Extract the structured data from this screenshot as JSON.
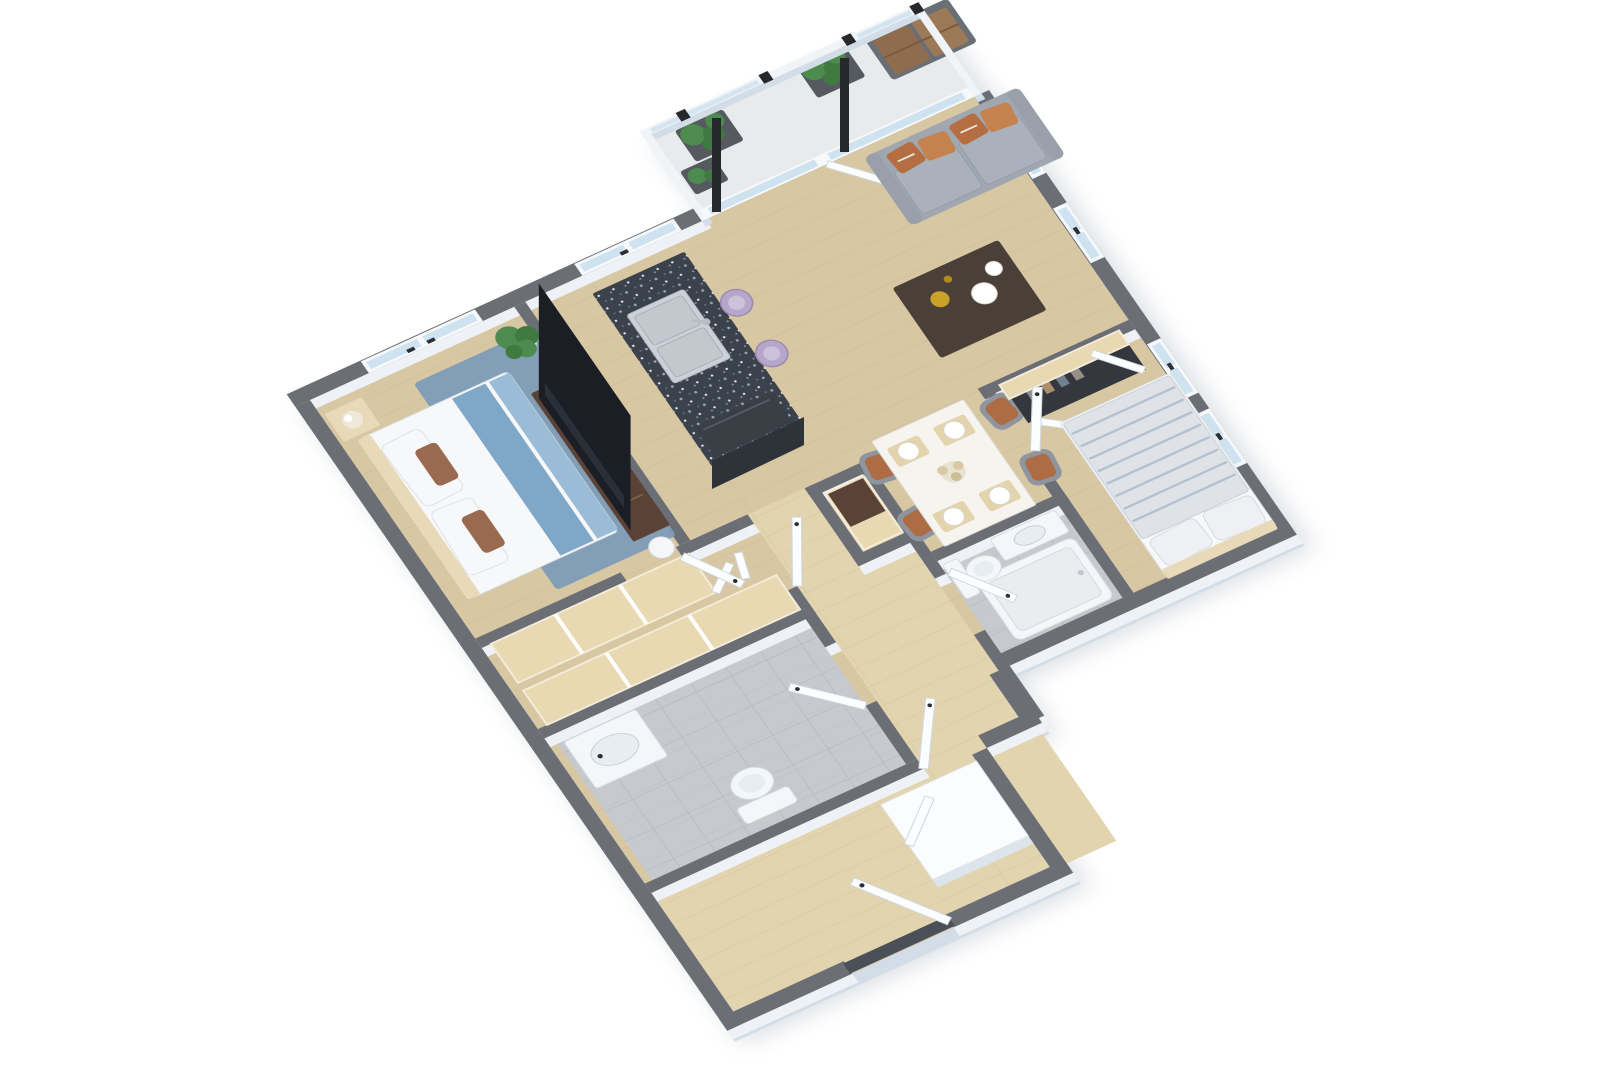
{
  "title": "3D isometric floor plan render — two-bedroom, two-bath apartment with balcony",
  "render_style": "top-down 3D dollhouse view, rotated ~40 degrees, no text labels in image",
  "palette": {
    "walltop": "#6b6f75",
    "wallside": "#eef2f6",
    "extside": "#d2dde7",
    "railwhite": "#f0f4f7",
    "glass": "#cfe2ef",
    "winframe": "#f6f9fb",
    "door": "#fcfdfe",
    "dooredge": "#cfd6dd",
    "handle": "#2c2f34",
    "floorwood": "#d8c7a3",
    "floorwoodlight": "#e2d4ae",
    "plank": "#b69e74",
    "balconyfloor": "#e8eaec",
    "tile": "#c6cacf",
    "tileline": "#a9aeb5",
    "granite": "#3b424c",
    "steel": "#ccd1d7",
    "fixture": "#f4f6f8",
    "sofa": "#a0a7b1",
    "sofaseat": "#aab1ba",
    "pillowrust": "#b56e42",
    "pillowrust2": "#c5824e",
    "tabledark": "#4a4038",
    "diningtable": "#f6f4ef",
    "chairshell": "#8e959f",
    "chairseat": "#ad6c44",
    "walnut": "#5a4336",
    "shelfwood": "#e9d9b2",
    "bedwhite": "#f7f8fa",
    "bedblue": "#7fa7c7",
    "rugblue": "#7e9cb8",
    "duvetgray": "#dfe3e8",
    "stripeblue": "#aebdcd",
    "headboard": "#e8d9b8",
    "plantgreen": "#4d8b4f",
    "plantdark": "#3f7a41",
    "pot": "#fbfbfb",
    "planter": "#555a60",
    "cushionbrown": "#8f6c4e",
    "cushionbrown2": "#9c7a58",
    "tv": "#1b1e24",
    "post": "#26282c",
    "appliance": "#3a3f45",
    "stool": "#b6a6c9",
    "stoolin": "#cdc2dc",
    "lamp": "#efe9da",
    "threshold": "#4b5058",
    "placemat": "#e3d4ae",
    "gold": "#c9a227"
  },
  "rooms": [
    {
      "id": "balcony",
      "label": "Balcony",
      "features": [
        "glass railing with black posts",
        "two dark planter boxes with green plants",
        "outdoor loveseat with two brown cushions"
      ]
    },
    {
      "id": "living-room",
      "label": "Living room",
      "features": [
        "gray sofa with four rust-orange pillows along glazed north wall",
        "dark coffee table with two white plates and gold decor",
        "two windows on east wall",
        "sliding glass door to balcony",
        "wood plank flooring"
      ]
    },
    {
      "id": "kitchen",
      "label": "Kitchen",
      "features": [
        "island with dark speckled granite counter",
        "double stainless-steel sink with faucet",
        "dark dishwasher front at island end",
        "two lavender bar stools",
        "window on north wall"
      ]
    },
    {
      "id": "dining-area",
      "label": "Dining area",
      "features": [
        "white rectangular table with four place settings and centerpiece",
        "four chairs with gray shells and terracotta seats",
        "wood cabinet beside pantry shelf"
      ]
    },
    {
      "id": "bedroom-1",
      "label": "Bedroom 1 (left)",
      "features": [
        "bed with white duvet and steel-blue runner",
        "brown accent pillows",
        "blue area rug",
        "beige nightstand with white sphere lamp",
        "walnut TV console with large television and flower vase",
        "potted plant in corner",
        "round white side table",
        "window on north wall"
      ]
    },
    {
      "id": "walkthrough-closet",
      "label": "Walk-through closet",
      "features": [
        "two wood-topped wardrobe runs",
        "white bifold doors"
      ]
    },
    {
      "id": "bathroom-1",
      "label": "Bathroom 1 (lower left)",
      "features": [
        "white vanity with sink",
        "toilet",
        "gray tile floor",
        "door from hallway"
      ]
    },
    {
      "id": "bathroom-2",
      "label": "Bathroom 2 (center right)",
      "features": [
        "bathtub",
        "toilet",
        "white vanity",
        "gray tile floor"
      ]
    },
    {
      "id": "bedroom-2",
      "label": "Bedroom 2 (right)",
      "features": [
        "bed with gray striped duvet and two pillows, headboard at south wall",
        "closet with wood shelf, hanging clothes and open white doors",
        "two windows on east wall"
      ]
    },
    {
      "id": "hallway-entry",
      "label": "Hallway and entry",
      "features": [
        "light wood plank floor",
        "front door at bottom tip with dark threshold",
        "white storage closet volume",
        "multiple open white door leaves with dark handles"
      ]
    }
  ],
  "counts": {
    "bedrooms": 2,
    "bathrooms": 2,
    "windows": 6,
    "door_leaves": 10,
    "plants": 4,
    "bar_stools": 2,
    "dining_chairs": 4
  },
  "colors_summary": {
    "wall_tops": "dark slate gray",
    "wall_faces": "white with pale blue tint",
    "floors": "light oak wood",
    "bathroom_floors": "gray tile",
    "accents": [
      "rust-orange sofa pillows",
      "steel-blue bedding",
      "lavender stools",
      "terracotta chair seats",
      "green plants"
    ]
  }
}
